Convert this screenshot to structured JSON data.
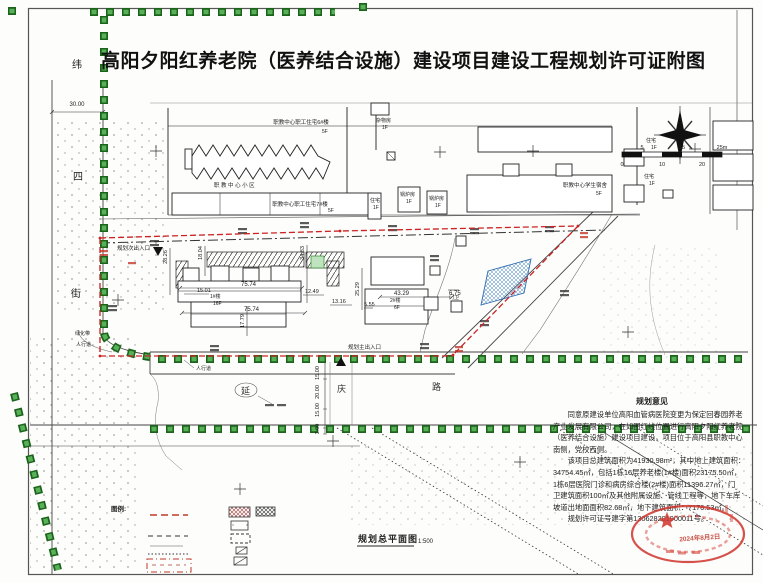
{
  "title": "高阳夕阳红养老院（医养结合设施）建设项目建设工程规划许可证附图",
  "streets": {
    "west": [
      "纬",
      "四",
      "街"
    ],
    "south": [
      "延",
      "庆",
      "路"
    ]
  },
  "labels": {
    "dorm6": "职教中心职工住宅6#楼",
    "dorm6_f": "5F",
    "dorm7": "职教中心职工住宅7#楼",
    "dorm7_f": "5F",
    "student_dorm": "职教中心学生宿舍",
    "student_dorm_f": "5F",
    "misc": "杂物房",
    "misc_f": "1F",
    "boiler": "锅炉房",
    "boiler_f": "1F",
    "house": "住宅",
    "house_f": "1F",
    "campus_zone": "职 教 中 心 小 区",
    "bldg1": "1#楼",
    "bldg1_f": "16F",
    "bldg2": "2#楼",
    "bldg2_f": "6F",
    "gate": "门卫",
    "entry_main": "规划主出入口",
    "entry_side": "规划次出入口",
    "sidewalk": "人行道",
    "greenbelt": "绿化带"
  },
  "dims": [
    "30.00",
    "28.26",
    "18.04",
    "34.83",
    "15.01",
    "75.74",
    "75.74",
    "17.79",
    "12.49",
    "13.16",
    "25.29",
    "5.55",
    "43.29",
    "6.75",
    "15.00",
    "20.00",
    "15.00",
    "3.00"
  ],
  "scalebar": {
    "above": [
      "5",
      "15",
      "25m"
    ],
    "below": [
      "0",
      "10",
      "20"
    ]
  },
  "opinion": {
    "heading": "规划意见",
    "lines": [
      "同意原建设单位高阳血管病医院变更为保定回春园养老",
      "产业发展有限公司，在如图红线位置进行高阳夕阳红养老院",
      "（医养结合设施）建设项目建设，项目位于高阳县职教中心",
      "南侧，党校西侧。",
      "该项目总建筑面积为41930.98m²，其中地上建筑面积：",
      "34754.45㎡，包括1栋16层养老楼(1#楼)面积23175.50㎡，",
      "1栋6层医院门诊和病房综合楼(2#楼)面积11396.27㎡，门",
      "卫建筑面积100㎡及其他附属设施、管线工程等，地下车库",
      "坡道出地面面积82.68㎡，地下建筑面积：7176.53㎡。",
      "规划许可证号建字第130628201900011号。"
    ]
  },
  "stamp": {
    "date": "2024年8月2日"
  },
  "legend": {
    "label": "图例:"
  },
  "drawing": {
    "name": "规划总平面图",
    "scale": "1:500"
  }
}
